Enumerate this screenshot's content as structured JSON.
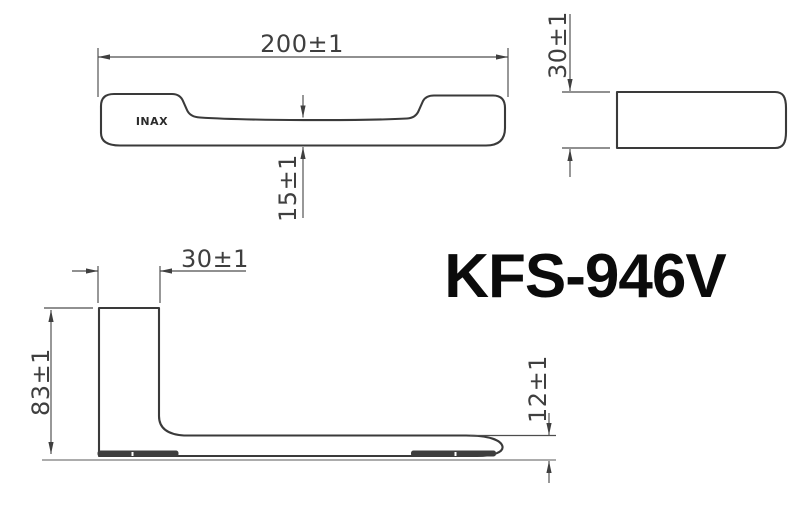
{
  "drawing": {
    "model_label": "KFS-946V",
    "brand_logo": "INAX",
    "front_view": {
      "overall_width": "200±1",
      "grip_clearance": "15±1"
    },
    "end_view": {
      "bar_height": "30±1"
    },
    "side_view": {
      "wall_depth": "30±1",
      "overall_height": "83±1",
      "tip_thickness": "12±1"
    }
  },
  "colors": {
    "background": "#ffffff",
    "outline": "#3a3a3a",
    "dimension_line": "#4d4d4d",
    "dimension_text": "#3f3f3f",
    "title_text": "#0b0b0b"
  }
}
